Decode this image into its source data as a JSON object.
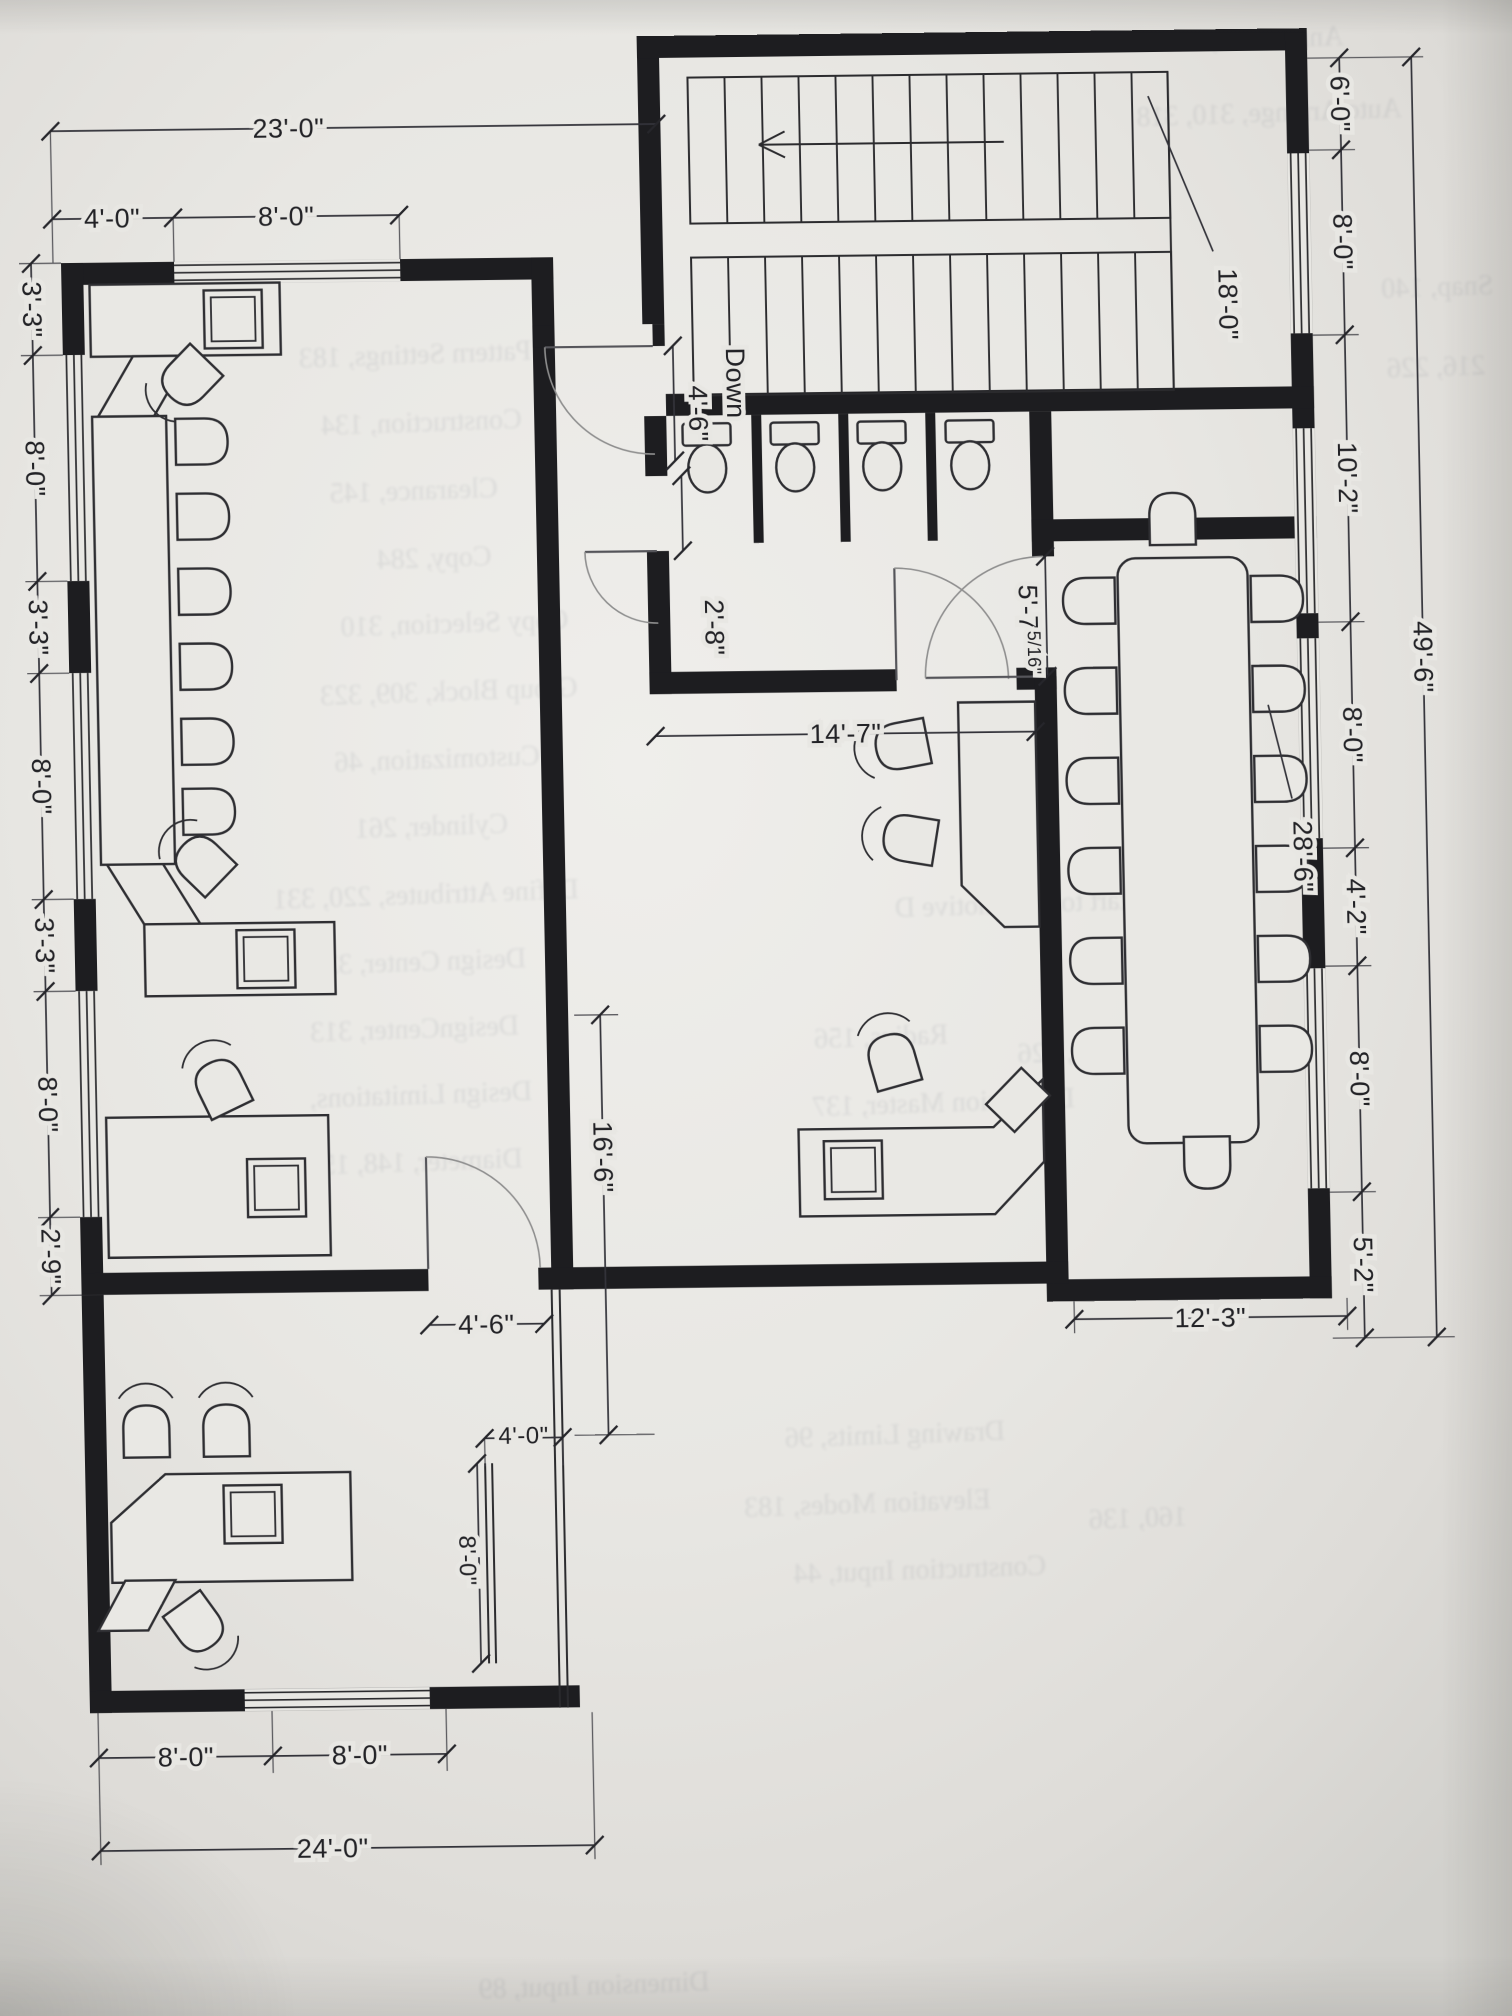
{
  "document": {
    "kind": "scanned floor plan exercise page",
    "stair_direction": "Down"
  },
  "dims": {
    "top_overall": "23'-0\"",
    "top_seg1": "4'-0\"",
    "top_seg2": "8'-0\"",
    "left": [
      "3'-3\"",
      "8'-0\"",
      "3'-3\"",
      "8'-0\"",
      "3'-3\"",
      "8'-0\"",
      "2'-9\""
    ],
    "right": [
      "6'-0\"",
      "8'-0\"",
      "10'-2\"",
      "8'-0\"",
      "4'-2\"",
      "8'-0\"",
      "5'-2\""
    ],
    "right_overall": "49'-6\"",
    "stair_length": "18'-0\"",
    "hall_door": "4'-6\"",
    "bath_door": "2'-8\"",
    "hall_width": "14'-7\"",
    "conf_gap_main": "5'-7",
    "conf_gap_frac": "5/16\"",
    "conf_width": "28'-6\"",
    "conf_below": "12'-3\"",
    "mid_vertical": "16'-6\"",
    "office_door": "4'-6\"",
    "nook_w": "4'-0\"",
    "nook_h": "8'-0\"",
    "bottom_seg1": "8'-0\"",
    "bottom_seg2": "8'-0\"",
    "bottom_overall": "24'-0\""
  },
  "ghost": [
    "Pattern Settings, 183",
    "Construction, 134",
    "Clearance, 145",
    "Copy, 284",
    "Copy Selection, 310",
    "Group Block, 309, 323",
    "Customization, 46",
    "Cylinder, 261",
    "Define Attributes, 220, 331",
    "Design Center, 323",
    "DesignCenter, 313",
    "Design Limitations,",
    "Diameter, 148, 156",
    "Quick Start to Automotive D",
    "Radius, 156",
    "Dimension Master, 137",
    "Drawing Limits, 96",
    "Elevation Modes, 183",
    "Construction Input, 44",
    "Dimension Input, 89",
    "Annotation, 249",
    "Auto Arrange, 310, 318",
    "Snap, 140",
    "216, 226",
    "218, 326",
    "160, 136"
  ],
  "colors": {
    "paper": "#e8e7e3",
    "ink": "#222226",
    "wall": "#1d1d20",
    "ghost_text": "#7d828c"
  }
}
